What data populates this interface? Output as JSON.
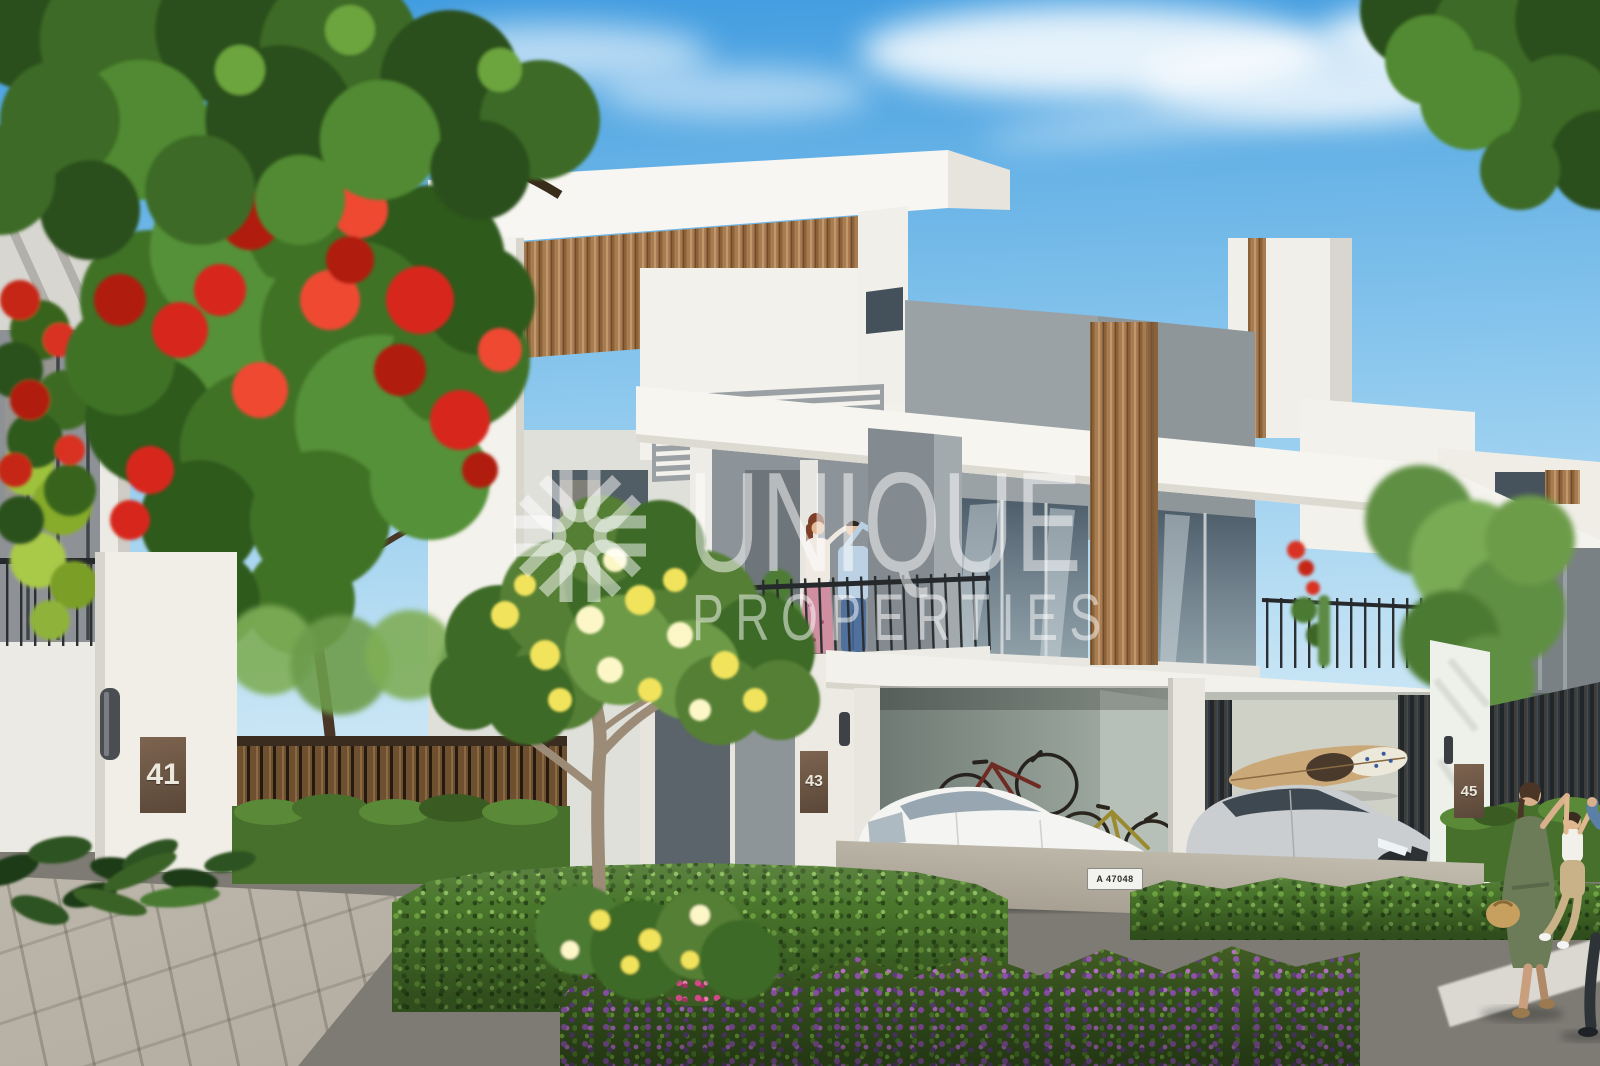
{
  "watermark": {
    "brand_line1": "UNIQUE",
    "brand_line2": "PROPERTIES",
    "logo": "sunburst-logo"
  },
  "villas": {
    "left_house_number": "41",
    "center_house_number": "43",
    "right_house_number": "45"
  },
  "vehicles": {
    "sedan_plate": "A 47048"
  },
  "palette": {
    "sky_top": "#3F9BE0",
    "sky_horizon": "#DDEEF8",
    "wall_white": "#F0EEE8",
    "concrete_gray": "#9AA1A5",
    "wood_brown": "#A87C50",
    "glass_blue": "#5D6D7A",
    "foliage_dark": "#2E5A1F",
    "foliage_light": "#79AB55",
    "flower_red": "#D7281A",
    "flower_yellow": "#F2E35C",
    "flower_purple": "#8B4FA8",
    "hedge_green": "#4A762C",
    "road_gray": "#6E6C66",
    "watermark_white": "#FFFFFF"
  }
}
